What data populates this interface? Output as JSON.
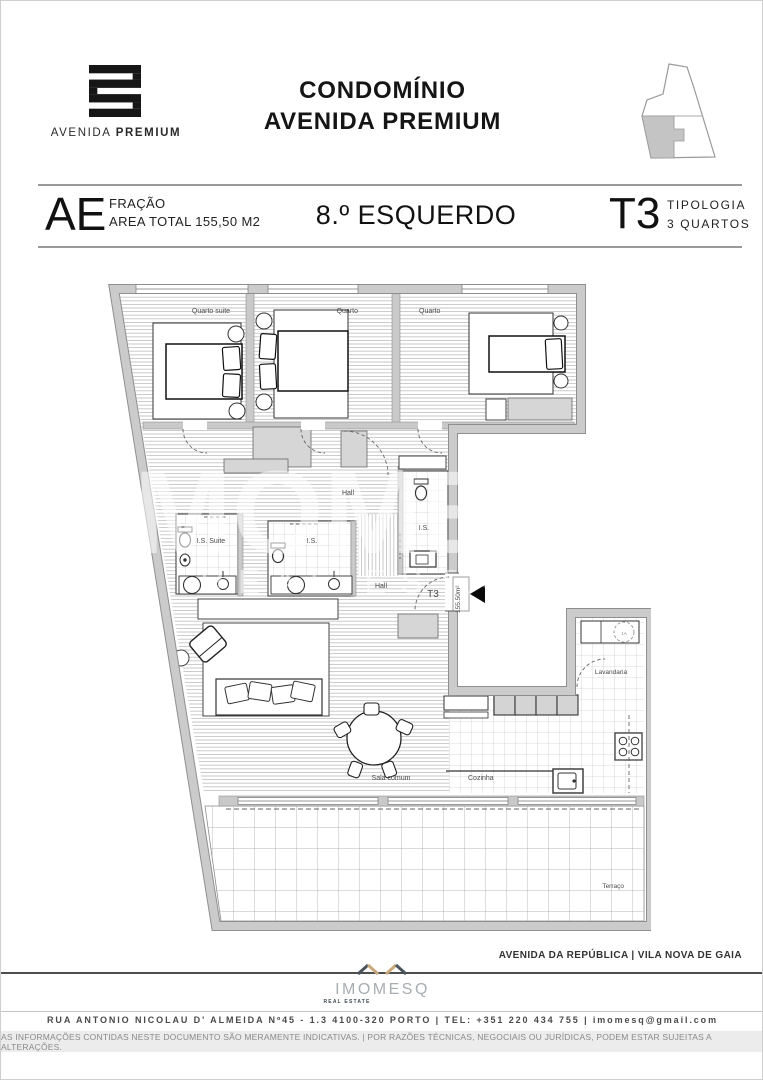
{
  "header": {
    "brand_normal": "AVENIDA",
    "brand_bold": "PREMIUM",
    "title_line1": "CONDOMÍNIO",
    "title_line2": "AVENIDA PREMIUM"
  },
  "info_bar": {
    "fraction_code": "AE",
    "fraction_label": "FRAÇÃO",
    "area_label": "AREA TOTAL 155,50 M2",
    "floor_name": "8.º ESQUERDO",
    "typology_code": "T3",
    "typology_label": "TIPOLOGIA",
    "typology_rooms": "3 QUARTOS"
  },
  "floorplan": {
    "rooms": {
      "quarto_suite": "Quarto suite",
      "quarto_2": "Quarto",
      "quarto_3": "Quarto",
      "hall_upper": "Hall",
      "is_suite": "I.S. Suite",
      "is_middle": "I.S.",
      "is_right": "I.S.",
      "hall_lower": "Hall",
      "lavandaria": "Lavandaria",
      "sala_comum": "Sala comum",
      "cozinha": "Cozinha",
      "terraco": "Terraço"
    },
    "entrance": {
      "type": "T3",
      "area": "155.50m²"
    },
    "washer_tag": "1A",
    "watermark": {
      "line1": "IMOMESQ",
      "line2": "REAL ESTATE"
    }
  },
  "footer": {
    "location": "AVENIDA DA REPÚBLICA | VILA NOVA DE GAIA",
    "agency_name": "IMOMESQ",
    "agency_sub": "REAL ESTATE",
    "address": "RUA ANTONIO NICOLAU D' ALMEIDA Nº45 - 1.3  4100-320 PORTO  |  TEL: +351 220 434 755  |  imomesq@gmail.com",
    "disclaimer": "AS INFORMAÇÕES CONTIDAS NESTE DOCUMENTO SÃO MERAMENTE INDICATIVAS.   |   POR RAZÕES TÉCNICAS, NEGOCIAIS OU JURÍDICAS, PODEM ESTAR SUJEITAS A ALTERAÇÕES."
  },
  "colors": {
    "wall": "#c9c9c9",
    "wall_edge": "#8f8f8f",
    "accent_gold": "#c9a87c",
    "accent_slate": "#4a545c",
    "text_dark": "#1a1a1a",
    "text_gray": "#555555"
  }
}
